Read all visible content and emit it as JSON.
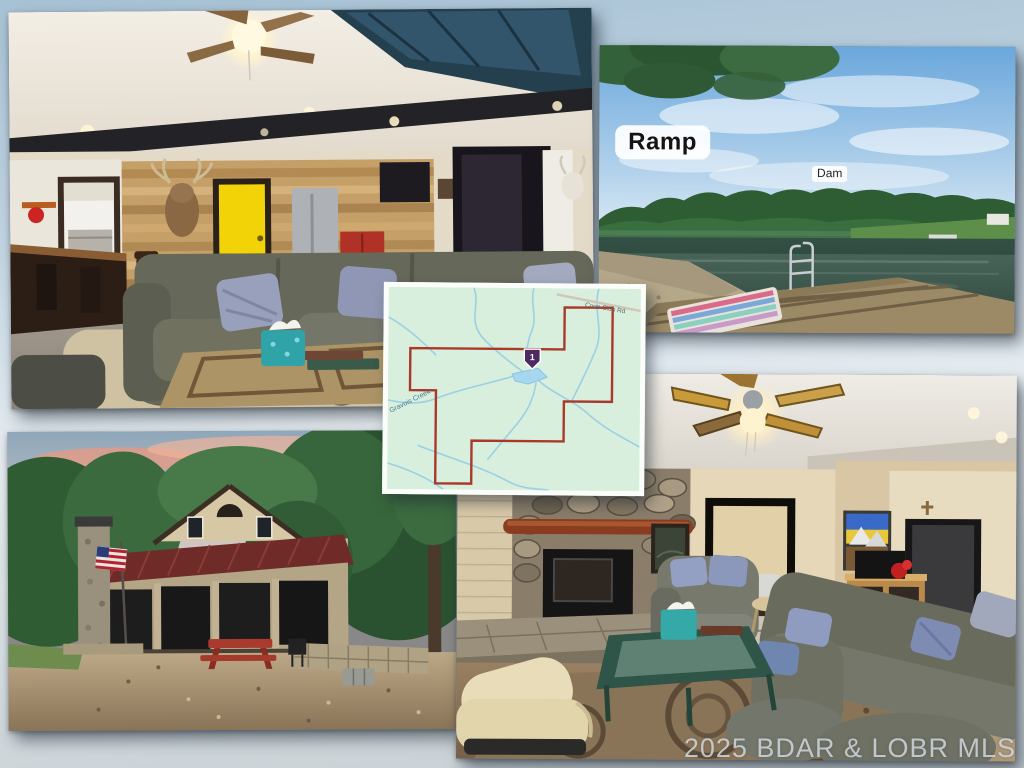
{
  "page": {
    "title": "Real estate MLS photo collage"
  },
  "watermark": {
    "text": "2025 BDAR & LOBR MLS",
    "color": "#d6dce0"
  },
  "photo_labels": {
    "ramp": "Ramp",
    "dam": "Dam"
  },
  "photos": {
    "living_room": {
      "description": "Open living area with ceiling fan, skylight, dark beam, wood plank accent wall, deer mount, yellow door, dining chairs, gray sectional sofa, window coffee table with teal tissue box"
    },
    "lake": {
      "description": "Private lake with tree-lined shore, swim dock with metal ladder and colorful blanket, gravel ramp, labeled Ramp and Dam"
    },
    "exterior": {
      "description": "Cabin with maroon metal roof, screened porch, stone chimney, American flag, red picnic table, gravel yard at sunset"
    },
    "family_room": {
      "description": "Lower level family room with stone fireplace, wood stove, log mantel, gray sectional with blue pillows, cream recliner, green coffee table, ceiling fan"
    }
  },
  "map": {
    "road_label": "Coon Club Rd",
    "creek_label": "Gravois Creek",
    "marker_label": "1",
    "boundary_color": "#a8392b",
    "water_color": "#9cd0e4",
    "land_color": "#d7efdc",
    "marker_color": "#4e2a62"
  }
}
